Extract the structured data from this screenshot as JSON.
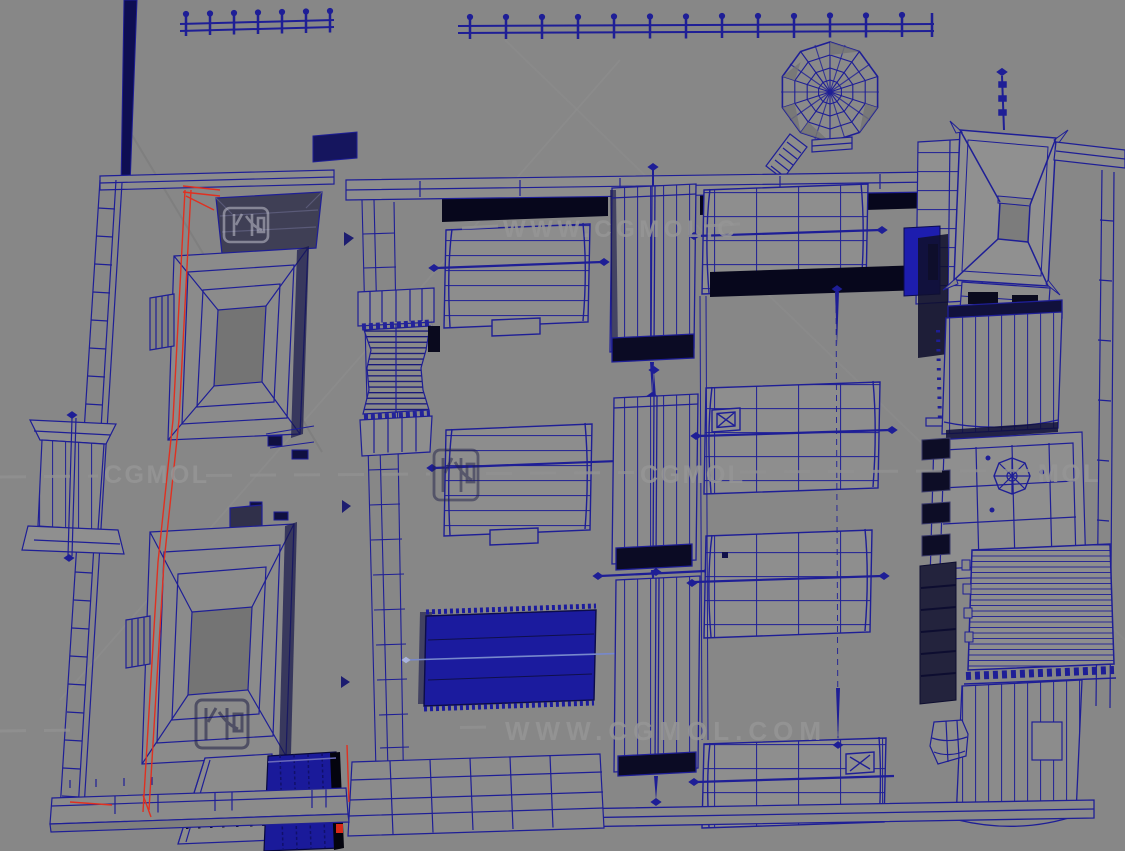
{
  "app": {
    "view": "3d-wireframe-viewport",
    "scene": "ancient-chinese-temple-complex-top-view"
  },
  "colors": {
    "viewport_background": "#878787",
    "wireframe": "#1e1e96",
    "wireframe_dark": "#0d0d4a",
    "shadow_black": "#07071c",
    "selected_edge_red": "#e03020",
    "solid_fill_blue": "#1b1b9e",
    "face_gray": "#8d8d8d",
    "watermark_gray": "#969696"
  },
  "watermarks": {
    "top_text": "WWW.CGMOL.C",
    "mid_left_text": "CGMOL",
    "mid_center_text": "CGMOL",
    "mid_right_text": "MOL",
    "bottom_text": "WWW.CGMOL.COM",
    "logo_icon": "cgmol-logo"
  }
}
